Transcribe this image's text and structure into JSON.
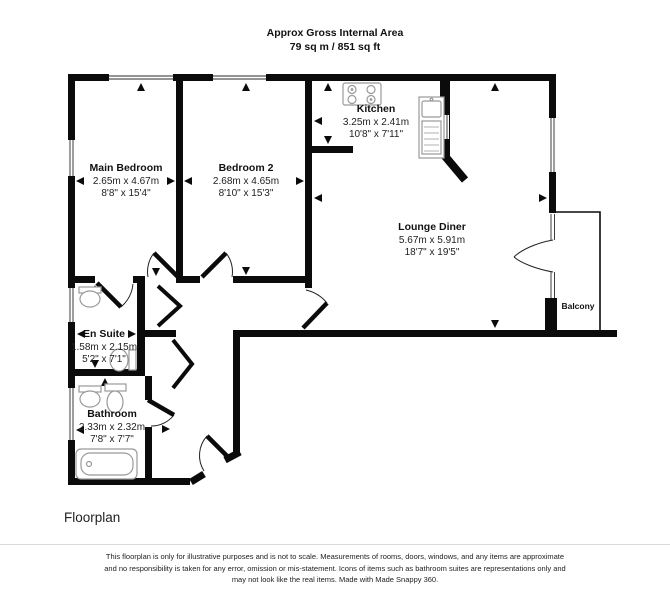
{
  "header": {
    "line1": "Approx Gross Internal Area",
    "line2": "79 sq m / 851 sq ft"
  },
  "rooms": [
    {
      "id": "main-bedroom",
      "name": "Main Bedroom",
      "metric": "2.65m x 4.67m",
      "imperial": "8'8\" x 15'4\""
    },
    {
      "id": "bedroom-2",
      "name": "Bedroom 2",
      "metric": "2.68m x 4.65m",
      "imperial": "8'10\" x 15'3\""
    },
    {
      "id": "kitchen",
      "name": "Kitchen",
      "metric": "3.25m x 2.41m",
      "imperial": "10'8\" x 7'11\""
    },
    {
      "id": "lounge-diner",
      "name": "Lounge Diner",
      "metric": "5.67m x 5.91m",
      "imperial": "18'7\" x 19'5\""
    },
    {
      "id": "en-suite",
      "name": "En Suite",
      "metric": "1.58m x 2.15m",
      "imperial": "5'2\" x 7'1\""
    },
    {
      "id": "bathroom",
      "name": "Bathroom",
      "metric": "2.33m x 2.32m",
      "imperial": "7'8\" x 7'7\""
    },
    {
      "id": "balcony",
      "name": "Balcony"
    }
  ],
  "fixtures": [
    "stove-icon",
    "kitchen-sink-icon",
    "basin-icon",
    "toilet-icon",
    "bathtub-icon"
  ],
  "footer": {
    "label": "Floorplan",
    "line1": "This floorplan is only for illustrative purposes and is not to scale. Measurements of rooms, doors, windows, and any items are approximate",
    "line2": "and no responsibility is taken for any error, omission or mis-statement. Icons of items such as bathroom suites are representations only and",
    "line3": "may not look like the real items. Made with Made Snappy 360."
  },
  "colors": {
    "wall": "#0b0b0b",
    "fixture": "#999999",
    "window_line": "#2a2a2a"
  }
}
